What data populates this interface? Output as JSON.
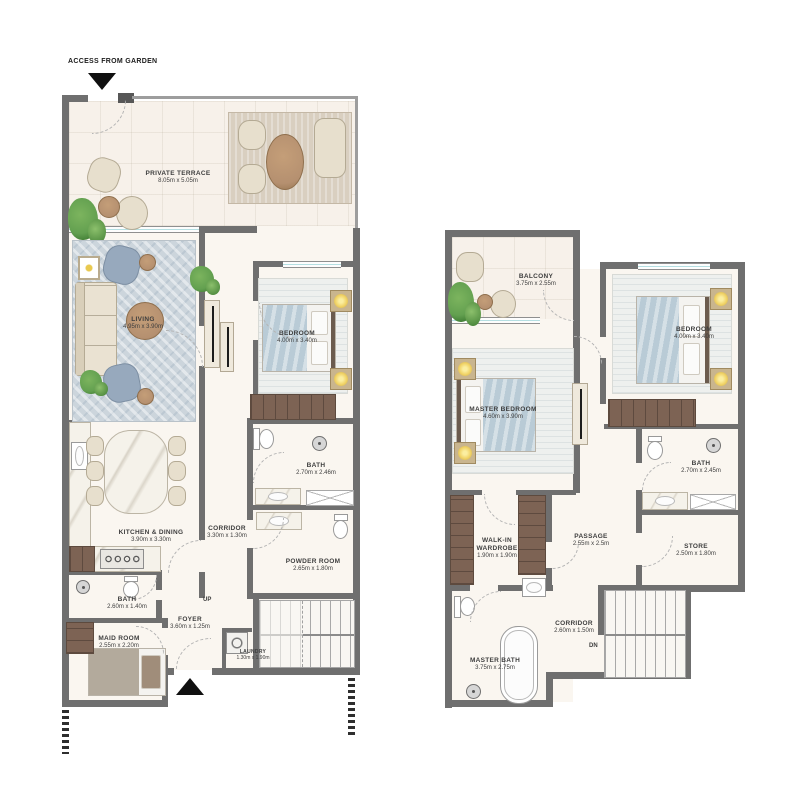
{
  "colors": {
    "wall": "#6f6f6f",
    "wall-dark": "#575757",
    "floor": "#faf6f0",
    "terrace": "#f7f1ea",
    "window": "#b5dfe2",
    "wardrobe": "#7d6354",
    "rug-blue": "#ccd5dc",
    "rug-beige": "#d9cfc0",
    "sofa": "#eae2d2",
    "chair-blue": "#97a9bd",
    "table-tan": "#b59070",
    "blanket": "#b9cbd6",
    "light": "#f1d468",
    "plant": "#63a050",
    "fixture-border": "#9a9a9a",
    "label": "#3e3e3e"
  },
  "annotations": {
    "access": "ACCESS FROM GARDEN",
    "up": "UP",
    "dn": "DN"
  },
  "ground_floor": {
    "rooms": {
      "private_terrace": {
        "name": "PRIVATE TERRACE",
        "dims": "8.05m x 5.05m"
      },
      "living": {
        "name": "LIVING",
        "dims": "4.95m x 3.90m"
      },
      "bedroom": {
        "name": "BEDROOM",
        "dims": "4.00m x 3.40m"
      },
      "bath": {
        "name": "BATH",
        "dims": "2.70m x 2.46m"
      },
      "corridor": {
        "name": "CORRIDOR",
        "dims": "3.30m x 1.30m"
      },
      "powder_room": {
        "name": "POWDER ROOM",
        "dims": "2.65m x 1.80m"
      },
      "kitchen_dining": {
        "name": "KITCHEN & DINING",
        "dims": "3.90m x 3.30m"
      },
      "maid_bath": {
        "name": "BATH",
        "dims": "2.60m x 1.40m"
      },
      "maid_room": {
        "name": "MAID ROOM",
        "dims": "2.55m x 2.20m"
      },
      "foyer": {
        "name": "FOYER",
        "dims": "3.60m x 1.25m"
      },
      "laundry": {
        "name": "LAUNDRY",
        "dims": "1.30m x 1.90m"
      }
    }
  },
  "first_floor": {
    "rooms": {
      "balcony": {
        "name": "BALCONY",
        "dims": "3.75m x 2.55m"
      },
      "master_bedroom": {
        "name": "MASTER BEDROOM",
        "dims": "4.60m x 3.90m"
      },
      "bedroom": {
        "name": "BEDROOM",
        "dims": "4.00m x 3.40m"
      },
      "bath": {
        "name": "BATH",
        "dims": "2.70m x 2.45m"
      },
      "store": {
        "name": "STORE",
        "dims": "2.50m x 1.80m"
      },
      "walk_in_wardrobe": {
        "name": "WALK-IN WARDROBE",
        "dims": "1.90m x 1.90m"
      },
      "passage": {
        "name": "PASSAGE",
        "dims": "2.55m x 2.5m"
      },
      "corridor": {
        "name": "CORRIDOR",
        "dims": "2.60m x 1.50m"
      },
      "master_bath": {
        "name": "MASTER BATH",
        "dims": "3.75m x 2.75m"
      }
    }
  }
}
